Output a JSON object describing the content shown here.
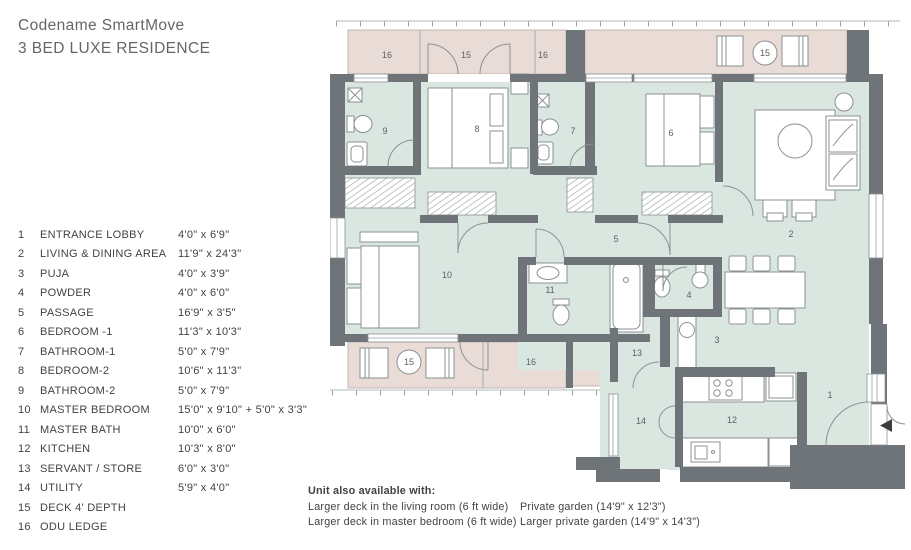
{
  "header": {
    "title_line1": "Codename SmartMove",
    "title_line2": "3 BED LUXE RESIDENCE"
  },
  "legend": {
    "items": [
      {
        "num": "1",
        "name": "ENTRANCE LOBBY",
        "dim": "4'0\" x 6'9\""
      },
      {
        "num": "2",
        "name": "LIVING & DINING AREA",
        "dim": "11'9\" x 24'3\""
      },
      {
        "num": "3",
        "name": "PUJA",
        "dim": "4'0\" x 3'9\""
      },
      {
        "num": "4",
        "name": "POWDER",
        "dim": "4'0\" x 6'0\""
      },
      {
        "num": "5",
        "name": "PASSAGE",
        "dim": "16'9\" x 3'5\""
      },
      {
        "num": "6",
        "name": "BEDROOM -1",
        "dim": "11'3\" x 10'3\""
      },
      {
        "num": "7",
        "name": "BATHROOM-1",
        "dim": "5'0\" x 7'9\""
      },
      {
        "num": "8",
        "name": "BEDROOM-2",
        "dim": "10'6\" x 11'3\""
      },
      {
        "num": "9",
        "name": "BATHROOM-2",
        "dim": "5'0\" x 7'9\""
      },
      {
        "num": "10",
        "name": "MASTER BEDROOM",
        "dim": "15'0\" x 9'10\" + 5'0\" x 3'3\""
      },
      {
        "num": "11",
        "name": "MASTER BATH",
        "dim": "10'0\" x 6'0\""
      },
      {
        "num": "12",
        "name": "KITCHEN",
        "dim": "10'3\" x 8'0\""
      },
      {
        "num": "13",
        "name": "SERVANT / STORE",
        "dim": "6'0\" x 3'0\""
      },
      {
        "num": "14",
        "name": "UTILITY",
        "dim": "5'9\" x 4'0\""
      },
      {
        "num": "15",
        "name": "DECK 4' DEPTH",
        "dim": ""
      },
      {
        "num": "16",
        "name": "ODU LEDGE",
        "dim": ""
      }
    ]
  },
  "notes": {
    "title": "Unit also available with:",
    "left_1": "Larger deck in the living room (6 ft wide)",
    "left_2": "Larger deck in master bedroom (6 ft wide)",
    "right_1": "Private garden (14'9\" x 12'3\")",
    "right_2": "Larger private garden (14'9\" x 14'3\")"
  },
  "plan": {
    "labels": {
      "top_odu_left": "16",
      "top_deck": "15",
      "top_odu_mid": "16",
      "top_deck_table": "15",
      "bathroom2": "9",
      "bedroom2": "8",
      "bathroom1": "7",
      "bedroom1": "6",
      "living": "2",
      "passage": "5",
      "master_bedroom": "10",
      "master_bath": "11",
      "powder": "4",
      "puja": "3",
      "servant": "13",
      "bottom_deck_table": "15",
      "bottom_odu": "16",
      "utility": "14",
      "kitchen": "12",
      "lobby": "1"
    },
    "colors": {
      "wall": "#6e7477",
      "room": "#dae7e1",
      "deck": "#e9dcd6",
      "fixture_outline": "#8b9192",
      "label_text": "#5a6163",
      "entry_arrow": "#3a3e40"
    }
  }
}
